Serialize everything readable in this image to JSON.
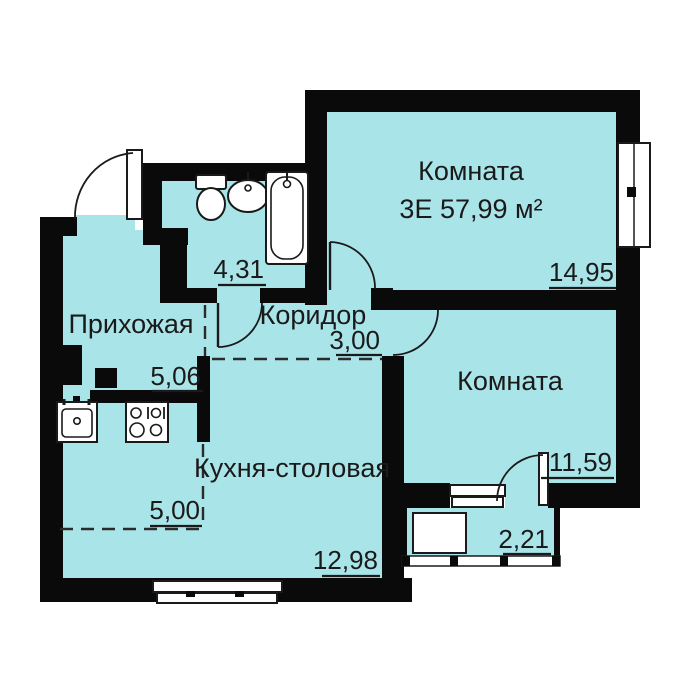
{
  "colors": {
    "floor": "#a9e4e8",
    "wall": "#0a0a0a",
    "text": "#1a1a1a"
  },
  "rooms": {
    "room_top": {
      "name": "Комната",
      "spec": "3Е 57,99 м²",
      "area": "14,95"
    },
    "room_right": {
      "name": "Комната",
      "area": "11,59"
    },
    "hallway": {
      "name": "Прихожая",
      "area": "5,06"
    },
    "corridor": {
      "name": "Коридор",
      "area": "3,00"
    },
    "kitchen": {
      "name": "Кухня-столовая",
      "area_niche": "5,00",
      "area": "12,98"
    },
    "bathroom": {
      "area": "4,31"
    },
    "balcony": {
      "area": "2,21"
    }
  },
  "fixtures": [
    "toilet",
    "sink",
    "bathtub",
    "kitchen-sink",
    "stove"
  ]
}
